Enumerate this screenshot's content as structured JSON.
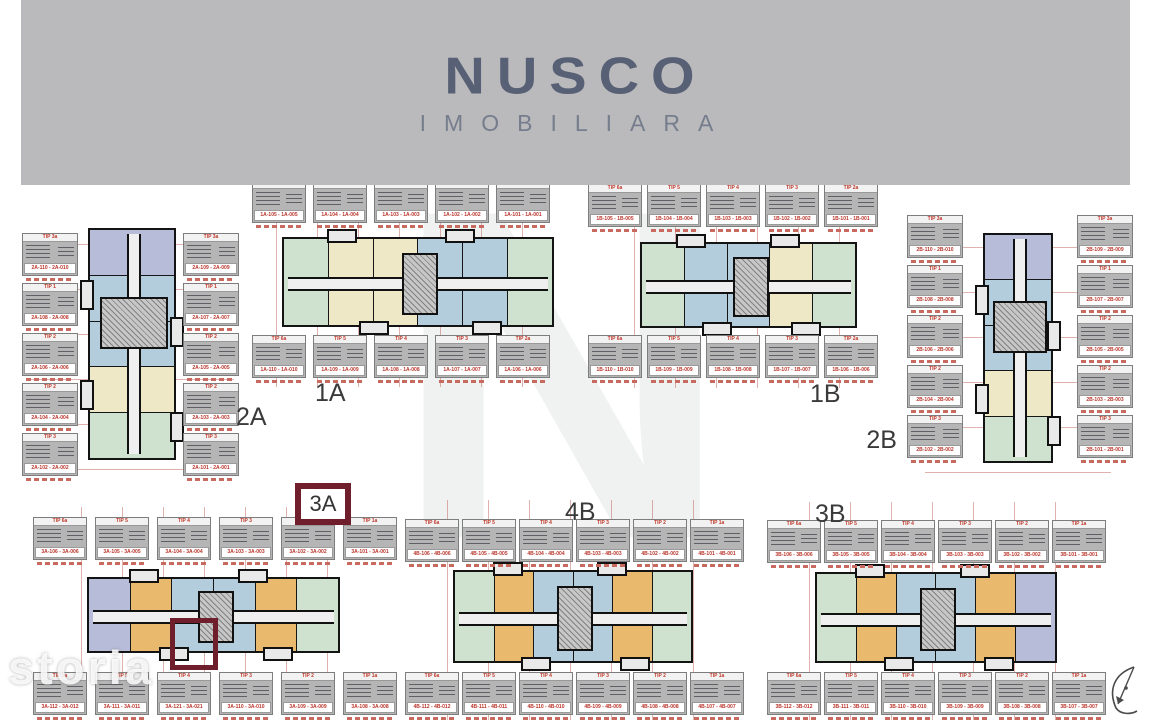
{
  "brand": {
    "name": "NUSCO",
    "tagline": "IMOBILIARA"
  },
  "watermark_text": "storia",
  "background_letter": "N",
  "colors": {
    "banner_bg": "#bababc",
    "logo": "#576075",
    "highlight": "#6e1f2b",
    "label_red": "#b8342a",
    "card_gray": "#b5b5b6"
  },
  "palette": {
    "lavender": "#b7bcd8",
    "blue": "#b4cddc",
    "cream": "#efe8c6",
    "green": "#cfe2d0",
    "orange": "#e9ba6e"
  },
  "buildings": [
    {
      "code": "2A",
      "type": "tower",
      "css": "b-2a",
      "units": [
        "lavender",
        "blue",
        "blue",
        "cream",
        "green"
      ],
      "label_groups": [
        {
          "side": "left",
          "labels": [
            {
              "tip": "TIP 3a",
              "range": "2A-110 - 2A-010"
            },
            {
              "tip": "TIP 1",
              "range": "2A-108 - 2A-008"
            },
            {
              "tip": "TIP 2",
              "range": "2A-106 - 2A-006"
            },
            {
              "tip": "TIP 2",
              "range": "2A-104 - 2A-004"
            },
            {
              "tip": "TIP 3",
              "range": "2A-102 - 2A-002"
            }
          ]
        },
        {
          "side": "right",
          "labels": [
            {
              "tip": "TIP 3a",
              "range": "2A-109 - 2A-009"
            },
            {
              "tip": "TIP 1",
              "range": "2A-107 - 2A-007"
            },
            {
              "tip": "TIP 2",
              "range": "2A-105 - 2A-005"
            },
            {
              "tip": "TIP 2",
              "range": "2A-103 - 2A-003"
            },
            {
              "tip": "TIP 3",
              "range": "2A-101 - 2A-001"
            }
          ]
        }
      ]
    },
    {
      "code": "1A",
      "type": "slab",
      "css": "b-1a",
      "units": [
        "green",
        "cream",
        "cream",
        "blue",
        "blue",
        "green"
      ],
      "label_groups": [
        {
          "side": "top",
          "labels": [
            {
              "tip": "TIP 6a",
              "range": "1A-105 - 1A-005"
            },
            {
              "tip": "TIP 5",
              "range": "1A-104 - 1A-004"
            },
            {
              "tip": "TIP 4",
              "range": "1A-103 - 1A-003"
            },
            {
              "tip": "TIP 3",
              "range": "1A-102 - 1A-002"
            },
            {
              "tip": "TIP 2a",
              "range": "1A-101 - 1A-001"
            }
          ]
        },
        {
          "side": "bottom",
          "labels": [
            {
              "tip": "TIP 6a",
              "range": "1A-110 - 1A-010"
            },
            {
              "tip": "TIP 5",
              "range": "1A-109 - 1A-009"
            },
            {
              "tip": "TIP 4",
              "range": "1A-108 - 1A-008"
            },
            {
              "tip": "TIP 3",
              "range": "1A-107 - 1A-007"
            },
            {
              "tip": "TIP 2a",
              "range": "1A-106 - 1A-006"
            }
          ]
        }
      ]
    },
    {
      "code": "1B",
      "type": "slab",
      "css": "b-1b",
      "units": [
        "green",
        "blue",
        "blue",
        "cream",
        "green"
      ],
      "label_groups": [
        {
          "side": "top",
          "labels": [
            {
              "tip": "TIP 6a",
              "range": "1B-105 - 1B-005"
            },
            {
              "tip": "TIP 5",
              "range": "1B-104 - 1B-004"
            },
            {
              "tip": "TIP 4",
              "range": "1B-103 - 1B-003"
            },
            {
              "tip": "TIP 3",
              "range": "1B-102 - 1B-002"
            },
            {
              "tip": "TIP 2a",
              "range": "1B-101 - 1B-001"
            }
          ]
        },
        {
          "side": "bottom",
          "labels": [
            {
              "tip": "TIP 6a",
              "range": "1B-110 - 1B-010"
            },
            {
              "tip": "TIP 5",
              "range": "1B-109 - 1B-009"
            },
            {
              "tip": "TIP 4",
              "range": "1B-108 - 1B-008"
            },
            {
              "tip": "TIP 3",
              "range": "1B-107 - 1B-007"
            },
            {
              "tip": "TIP 2a",
              "range": "1B-106 - 1B-006"
            }
          ]
        }
      ]
    },
    {
      "code": "2B",
      "type": "tower",
      "css": "b-2b",
      "units": [
        "lavender",
        "blue",
        "blue",
        "cream",
        "green"
      ],
      "label_groups": [
        {
          "side": "left",
          "labels": [
            {
              "tip": "TIP 3a",
              "range": "2B-110 - 2B-010"
            },
            {
              "tip": "TIP 1",
              "range": "2B-108 - 2B-008"
            },
            {
              "tip": "TIP 2",
              "range": "2B-106 - 2B-006"
            },
            {
              "tip": "TIP 2",
              "range": "2B-104 - 2B-004"
            },
            {
              "tip": "TIP 3",
              "range": "2B-102 - 2B-002"
            }
          ]
        },
        {
          "side": "right",
          "labels": [
            {
              "tip": "TIP 3a",
              "range": "2B-109 - 2B-009"
            },
            {
              "tip": "TIP 1",
              "range": "2B-107 - 2B-007"
            },
            {
              "tip": "TIP 2",
              "range": "2B-105 - 2B-005"
            },
            {
              "tip": "TIP 2",
              "range": "2B-103 - 2B-003"
            },
            {
              "tip": "TIP 3",
              "range": "2B-101 - 2B-001"
            }
          ]
        }
      ]
    },
    {
      "code": "3A",
      "type": "slab",
      "css": "b-3a",
      "code_boxed": true,
      "has_unit_highlight": true,
      "units": [
        "lavender",
        "orange",
        "blue",
        "blue",
        "orange",
        "green"
      ],
      "label_groups": [
        {
          "side": "top",
          "labels": [
            {
              "tip": "TIP 6a",
              "range": "3A-106 - 3A-006"
            },
            {
              "tip": "TIP 5",
              "range": "3A-105 - 3A-005"
            },
            {
              "tip": "TIP 4",
              "range": "3A-104 - 3A-004"
            },
            {
              "tip": "TIP 3",
              "range": "3A-103 - 3A-003"
            },
            {
              "tip": "TIP 2",
              "range": "3A-102 - 3A-002"
            },
            {
              "tip": "TIP 1a",
              "range": "3A-101 - 3A-001"
            }
          ]
        },
        {
          "side": "bottom",
          "labels": [
            {
              "tip": "TIP 6a",
              "range": "3A-112 - 3A-012"
            },
            {
              "tip": "TIP 5",
              "range": "3A-111 - 3A-011"
            },
            {
              "tip": "TIP 4",
              "range": "3A-121 - 3A-021"
            },
            {
              "tip": "TIP 3",
              "range": "3A-110 - 3A-010"
            },
            {
              "tip": "TIP 2",
              "range": "3A-109 - 3A-009"
            },
            {
              "tip": "TIP 1a",
              "range": "3A-108 - 3A-008"
            }
          ]
        }
      ]
    },
    {
      "code": "4B",
      "type": "slab",
      "css": "b-4b",
      "units": [
        "green",
        "orange",
        "blue",
        "blue",
        "orange",
        "green"
      ],
      "label_groups": [
        {
          "side": "top",
          "labels": [
            {
              "tip": "TIP 6a",
              "range": "4B-106 - 4B-006"
            },
            {
              "tip": "TIP 5",
              "range": "4B-105 - 4B-005"
            },
            {
              "tip": "TIP 4",
              "range": "4B-104 - 4B-004"
            },
            {
              "tip": "TIP 3",
              "range": "4B-103 - 4B-003"
            },
            {
              "tip": "TIP 2",
              "range": "4B-102 - 4B-002"
            },
            {
              "tip": "TIP 1a",
              "range": "4B-101 - 4B-001"
            }
          ]
        },
        {
          "side": "bottom",
          "labels": [
            {
              "tip": "TIP 6a",
              "range": "4B-112 - 4B-012"
            },
            {
              "tip": "TIP 5",
              "range": "4B-111 - 4B-011"
            },
            {
              "tip": "TIP 4",
              "range": "4B-110 - 4B-010"
            },
            {
              "tip": "TIP 3",
              "range": "4B-109 - 4B-009"
            },
            {
              "tip": "TIP 2",
              "range": "4B-108 - 4B-008"
            },
            {
              "tip": "TIP 1a",
              "range": "4B-107 - 4B-007"
            }
          ]
        }
      ]
    },
    {
      "code": "3B",
      "type": "slab",
      "css": "b-3b",
      "units": [
        "green",
        "orange",
        "blue",
        "blue",
        "orange",
        "lavender"
      ],
      "label_groups": [
        {
          "side": "top",
          "labels": [
            {
              "tip": "TIP 6a",
              "range": "3B-106 - 3B-006"
            },
            {
              "tip": "TIP 5",
              "range": "3B-105 - 3B-005"
            },
            {
              "tip": "TIP 4",
              "range": "3B-104 - 3B-004"
            },
            {
              "tip": "TIP 3",
              "range": "3B-103 - 3B-003"
            },
            {
              "tip": "TIP 2",
              "range": "3B-102 - 3B-002"
            },
            {
              "tip": "TIP 1a",
              "range": "3B-101 - 3B-001"
            }
          ]
        },
        {
          "side": "bottom",
          "labels": [
            {
              "tip": "TIP 6a",
              "range": "3B-112 - 3B-012"
            },
            {
              "tip": "TIP 5",
              "range": "3B-111 - 3B-011"
            },
            {
              "tip": "TIP 4",
              "range": "3B-110 - 3B-010"
            },
            {
              "tip": "TIP 3",
              "range": "3B-109 - 3B-009"
            },
            {
              "tip": "TIP 2",
              "range": "3B-108 - 3B-008"
            },
            {
              "tip": "TIP 1a",
              "range": "3B-107 - 3B-007"
            }
          ]
        }
      ]
    }
  ]
}
